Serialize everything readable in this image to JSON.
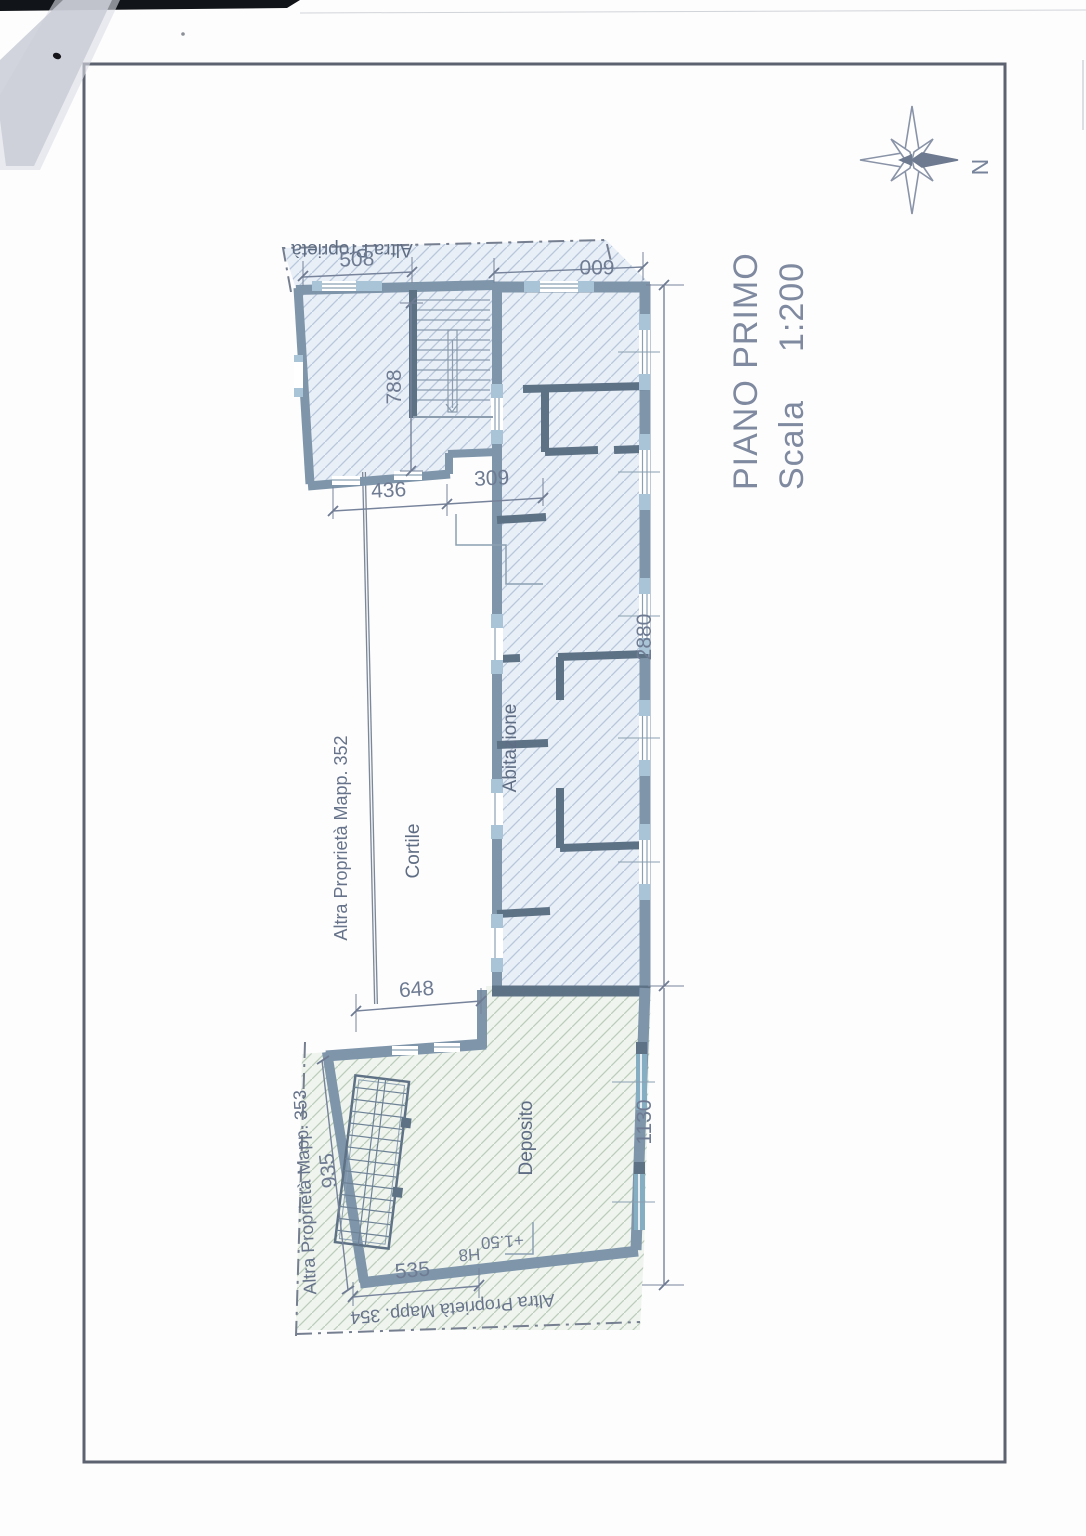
{
  "compass": {
    "label": "N"
  },
  "title": {
    "line1": "PIANO PRIMO",
    "scala_label": "Scala",
    "scala_value": "1:200"
  },
  "areas": {
    "altra_top": "Altra Proprietà",
    "abitazione": "Abitazione",
    "cortile": "Cortile",
    "deposito": "Deposito",
    "mapp352": "Altra Proprietà  Mapp. 352",
    "mapp353": "Altra Proprietà Mapp. 353",
    "mapp354": "Altra Proprietà Mapp. 354"
  },
  "dimensions": {
    "top_block_width": "508",
    "strip_top_width": "600",
    "stair_depth": "788",
    "block_bottom_width": "436",
    "jog_width": "309",
    "strip_length": "2880",
    "cortile_width": "648",
    "deposito_length": "1130",
    "deposito_side": "935",
    "deposito_bottom": "535",
    "level": "+1.50",
    "level_note": "H8"
  },
  "colors": {
    "wall": "#7e95aa",
    "wall_dark": "#5e7286",
    "hatch_blue": "#b7c7db",
    "hatch_green": "#bccdbb",
    "accent_text": "#7f8aa0"
  }
}
